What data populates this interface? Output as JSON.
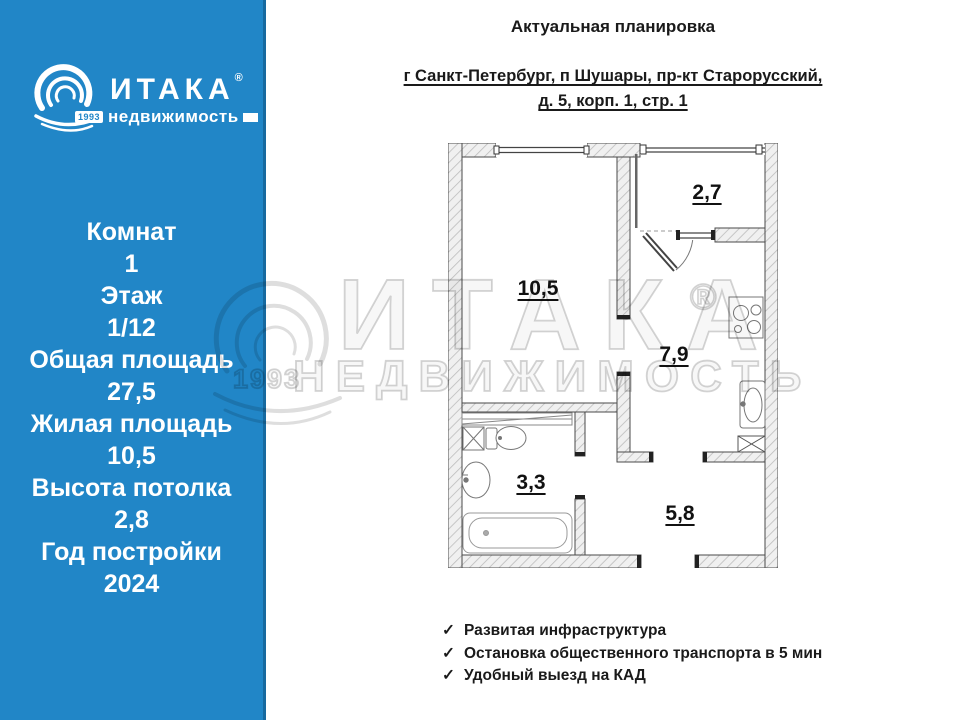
{
  "icons": {
    "check": "✓",
    "reg": "®"
  },
  "sidebar": {
    "bg_color": "#2186C7",
    "brand": {
      "name": "ИТАКА",
      "reg": "®",
      "sub": "недвижимость",
      "year": "1993"
    },
    "stats": [
      {
        "label": "Комнат",
        "value": "1"
      },
      {
        "label": "Этаж",
        "value": "1/12"
      },
      {
        "label": "Общая площадь",
        "value": "27,5"
      },
      {
        "label": "Жилая площадь",
        "value": "10,5"
      },
      {
        "label": "Высота потолка",
        "value": "2,8"
      },
      {
        "label": "Год постройки",
        "value": "2024"
      }
    ]
  },
  "header": {
    "title": "Актуальная планировка",
    "address_line1": "г Санкт-Петербург, п Шушары, пр-кт Старорусский,",
    "address_line2": "д. 5, корп. 1, стр. 1"
  },
  "floorplan": {
    "rooms": [
      {
        "name": "living-room",
        "area": "10,5"
      },
      {
        "name": "balcony",
        "area": "2,7"
      },
      {
        "name": "kitchen",
        "area": "7,9"
      },
      {
        "name": "bathroom",
        "area": "3,3"
      },
      {
        "name": "hallway",
        "area": "5,8"
      }
    ]
  },
  "features": [
    "Развитая инфраструктура",
    "Остановка общественного транспорта в 5 мин",
    "Удобный выезд на КАД"
  ],
  "watermark": {
    "brand": "ИТАКА",
    "reg": "®",
    "sub": "НЕДВИЖИМОСТЬ",
    "year": "1993"
  }
}
